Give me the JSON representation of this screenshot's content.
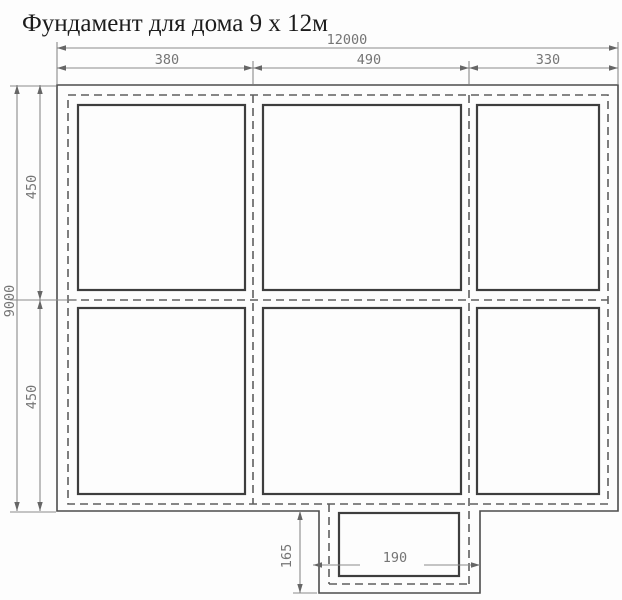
{
  "title": "Фундамент для дома 9 х 12м",
  "drawing": {
    "kind": "foundation-plan",
    "cells_visible": 6,
    "has_bottom_porch": true
  },
  "dimensions": {
    "top_total": "12000",
    "top_segments": [
      "380",
      "490",
      "330"
    ],
    "left_total": "9000",
    "left_segments": [
      "450",
      "450"
    ],
    "porch_depth": "165",
    "porch_width": "190"
  },
  "colors": {
    "background": "#fdfdfd",
    "title_text": "#1c1c1c",
    "wall_line": "#4d4d4d",
    "cell_line": "#3e3e3e",
    "dashed_line": "#5f5f5f",
    "dimension_line": "#8b8b8b",
    "dimension_arrow": "#666666",
    "dimension_text": "#757575"
  }
}
